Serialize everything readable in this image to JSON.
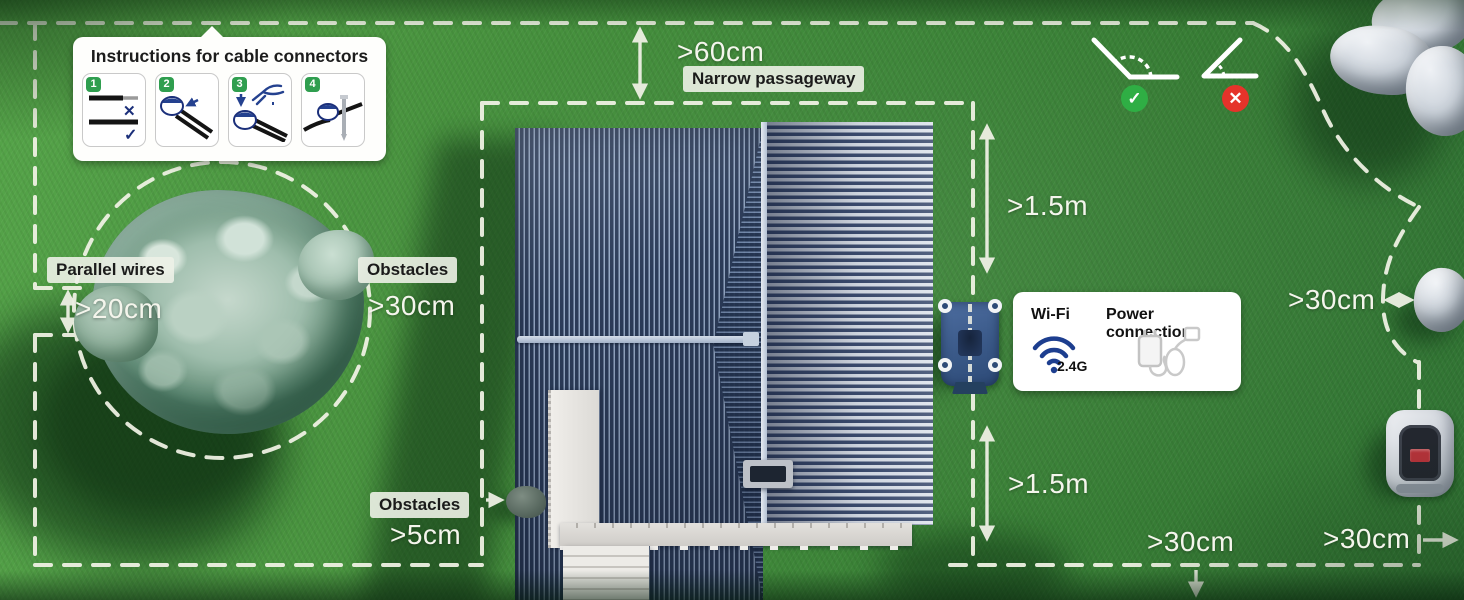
{
  "instructions_box": {
    "title": "Instructions for cable connectors",
    "steps": [
      {
        "num": "1",
        "name": "wire-prep"
      },
      {
        "num": "2",
        "name": "insert-wires"
      },
      {
        "num": "3",
        "name": "crimp-with-pliers"
      },
      {
        "num": "4",
        "name": "stake-connector"
      }
    ]
  },
  "connectivity_box": {
    "wifi_label": "Wi-Fi",
    "wifi_band": "2.4G",
    "power_label": "Power connection"
  },
  "annotations": {
    "narrow_passageway": {
      "label": "Narrow passageway",
      "value": ">60cm"
    },
    "parallel_wires": {
      "label": "Parallel wires",
      "value": ">20cm"
    },
    "tree_obstacle": {
      "label": "Obstacles",
      "value": ">30cm"
    },
    "clearance_above_station": {
      "value": ">1.5m"
    },
    "clearance_below_station": {
      "value": ">1.5m"
    },
    "rock_clearance": {
      "value": ">30cm"
    },
    "small_obstacle": {
      "label": "Obstacles",
      "value": ">5cm"
    },
    "bottom_boundary": {
      "value": ">30cm"
    },
    "right_boundary": {
      "value": ">30cm"
    }
  },
  "icons": {
    "good_corner_check": "✓",
    "bad_corner_cross": "✕",
    "wire_yes": "✓",
    "wire_no": "✕"
  },
  "colors": {
    "accent_green": "#2f9e4f",
    "error_red": "#e5332a",
    "wifi_blue": "#1d3e8f",
    "boundary_dash": "#f2f3e6",
    "roof_navy": "#2c3c59"
  }
}
